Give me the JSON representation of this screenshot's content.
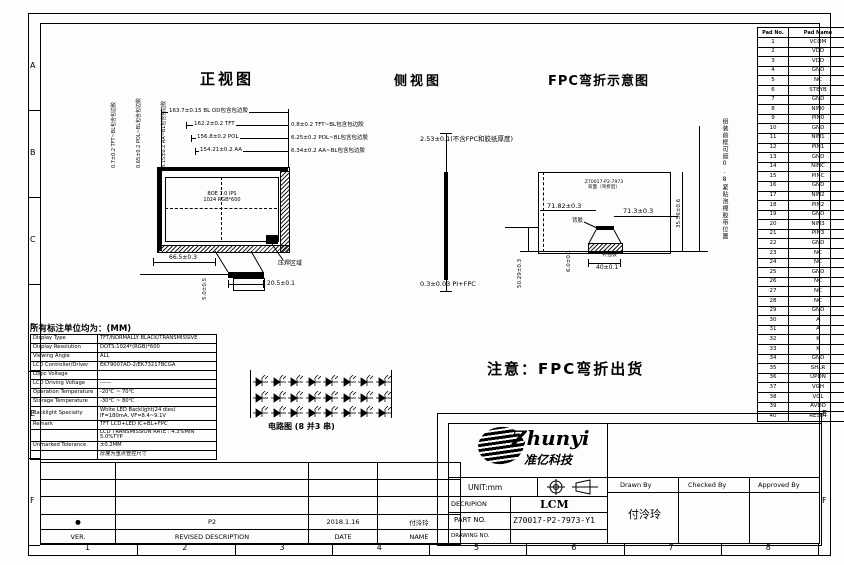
{
  "zones": {
    "bottom": [
      "1",
      "2",
      "3",
      "4",
      "5",
      "6",
      "7",
      "8"
    ],
    "left": [
      "A",
      "B",
      "C",
      "D",
      "E",
      "F"
    ],
    "right": [
      "E",
      "F"
    ]
  },
  "pin_table": {
    "headers": [
      "Pad No.",
      "Pad Name"
    ],
    "rows": [
      [
        "1",
        "VCOM"
      ],
      [
        "2",
        "VDD"
      ],
      [
        "3",
        "VDD"
      ],
      [
        "4",
        "GND"
      ],
      [
        "5",
        "NC"
      ],
      [
        "6",
        "STBYB"
      ],
      [
        "7",
        "GND"
      ],
      [
        "8",
        "NIN0"
      ],
      [
        "9",
        "PIN0"
      ],
      [
        "10",
        "GND"
      ],
      [
        "11",
        "NIN1"
      ],
      [
        "12",
        "PIN1"
      ],
      [
        "13",
        "GND"
      ],
      [
        "14",
        "NINC"
      ],
      [
        "15",
        "PINC"
      ],
      [
        "16",
        "GND"
      ],
      [
        "17",
        "NIN2"
      ],
      [
        "18",
        "PIN2"
      ],
      [
        "19",
        "GND"
      ],
      [
        "20",
        "NIN3"
      ],
      [
        "21",
        "PIN3"
      ],
      [
        "22",
        "GND"
      ],
      [
        "23",
        "NC"
      ],
      [
        "24",
        "NC"
      ],
      [
        "25",
        "GND"
      ],
      [
        "26",
        "NC"
      ],
      [
        "27",
        "NC"
      ],
      [
        "28",
        "NC"
      ],
      [
        "29",
        "GND"
      ],
      [
        "30",
        "A"
      ],
      [
        "31",
        "A"
      ],
      [
        "32",
        "K"
      ],
      [
        "33",
        "K"
      ],
      [
        "34",
        "GND"
      ],
      [
        "35",
        "SHLR"
      ],
      [
        "36",
        "UPDN"
      ],
      [
        "37",
        "VGH"
      ],
      [
        "38",
        "VGL"
      ],
      [
        "39",
        "AVDD"
      ],
      [
        "40",
        "RESET"
      ]
    ]
  },
  "front_view": {
    "title": "正视图",
    "width_dims": [
      "163.7±0.15 BL OD包含包边胶",
      "162.2±0.2 TFT",
      "156.8±0.2 POL",
      "154.21±0.2 AA"
    ],
    "right_offsets": [
      "0.8±0.2 TFT~BL包含包边胶",
      "6.25±0.2 POL~BL包含包边胶",
      "6.34±0.2 AA~BL包含包边胶"
    ],
    "left_offsets": [
      "0.7±0.2 TFT~BL包含包边胶",
      "0.65±0.2 POL~BL包含包边胶",
      "3.15±0.2 AA~BL包含包边胶"
    ],
    "panel_line1": "BOE 7.0 IPS",
    "panel_line2": "1024 RGB*600",
    "dim_left_bottom": "66.5±0.3",
    "dim_fpc_width": "20.5±0.1",
    "dim_fpc_drop": "5.0±0.5",
    "bonding_label": "压焊区域"
  },
  "side_view": {
    "title": "侧视图",
    "dim_thickness": "2.53±0.1(不含FPC和胶纸厚度)",
    "dim_pi": "0.3±0.03 PI+FPC"
  },
  "fpc_view": {
    "title": "FPC弯折示意图",
    "inner_line1": "Z70017-P2-7973",
    "inner_line2": "背面（弯折后）",
    "dim_left": "71.82±0.3",
    "dim_right": "71.3±0.3",
    "dim_connector": "40±0.1",
    "dim_gap": "6.0±0.1",
    "dim_height_left": "50.29±0.3",
    "dim_height_right": "35.56±0.6",
    "label_adhesive": "背胶",
    "label_stiffener": "补强板",
    "side_note": "组装前框可遮0.8紧贴泡棉胶带位置"
  },
  "shipping_note": "注意：FPC弯折出货",
  "circuit": {
    "caption": "电路图 (8 并3 串)",
    "parallel": 8,
    "series": 3
  },
  "spec_table": {
    "title": "所有标注单位均为：(MM)",
    "rows": [
      {
        "label": "Display Type",
        "value": "TFT/NORMALLY BLACK/TRANSMISSIVE"
      },
      {
        "label": "Display Resolution",
        "value": "DOTS:1024*(RGB)*600"
      },
      {
        "label": "Viewing Angle",
        "value": "ALL"
      },
      {
        "label": "LCD Controller/Driver",
        "value": "EK79007AD-2/EK73217BCGA"
      },
      {
        "label": "Logic Voltage",
        "value": ""
      },
      {
        "label": "LCD Driving Voltage",
        "value": "------"
      },
      {
        "label": "Operation Temperature",
        "value": "-20℃ ~ 70℃"
      },
      {
        "label": "Storage Temperature",
        "value": "-30℃ ~ 80℃"
      },
      {
        "label": "Backlight Specialty",
        "value": "White LED Backlight(24 dies)\nIF=180mA, VF=8.4~9.1V"
      },
      {
        "label": "Remark",
        "value": "TFT LCD+LED IC+BL+FPC"
      },
      {
        "label": "",
        "value": "LCD TRANSMISSION RATE : 4.3%MIN 5.0%TYP"
      },
      {
        "label": "Unmarked Tolerance",
        "value": "±0.2MM"
      },
      {
        "label": "",
        "value": "厚度为重点管控尺寸"
      }
    ]
  },
  "title_block": {
    "logo_text": "Zhunyi",
    "logo_cn": "准亿科技",
    "unit_label": "UNIT:mm",
    "description_label": "DECRIPION",
    "description_value": "LCM",
    "part_no_label": "PART NO.",
    "part_no_value": "Z70017-P2-7973-Y1",
    "drawing_no_label": "DRAWING NO.",
    "drawing_no_value": "",
    "drawn_by_label": "Drawn By",
    "checked_by_label": "Checked By",
    "approved_by_label": "Approved By",
    "drawn_by_value": "付泠玲"
  },
  "revision_table": {
    "headers": [
      "VER.",
      "REVISED DESCRIPTION",
      "DATE",
      "NAME"
    ],
    "rows": [
      [
        "",
        "",
        "",
        ""
      ],
      [
        "",
        "",
        "",
        ""
      ],
      [
        "",
        "",
        "",
        ""
      ],
      [
        "●",
        "P2",
        "2018.1.16",
        "付泠玲"
      ]
    ]
  }
}
